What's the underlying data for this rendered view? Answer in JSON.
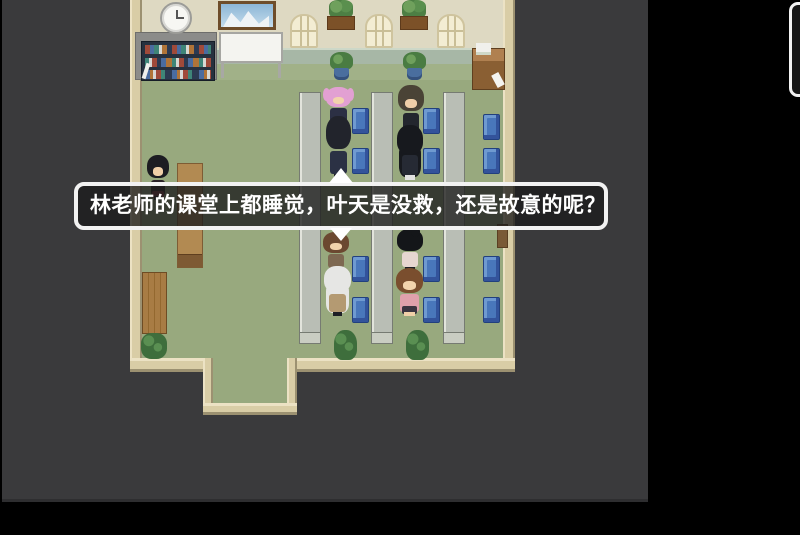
{
  "dialogue": {
    "text": "林老师的课堂上都睡觉，叶天是没救，还是故意的呢？",
    "text_color": "#ffffff",
    "border_color": "#f2f2f2",
    "box_fill": "rgba(28,28,28,0.78)",
    "speaker_tail": "up-triangle",
    "continue_indicator": "down-triangle"
  },
  "palette": {
    "outer_bg": "#000000",
    "viewport_bg": "#3a3a3c",
    "floor_green": "#98a97e",
    "wall_beige": "#ded9c2",
    "wainscot": "#a7b7a6",
    "wall_border_tan": "#d9cda6",
    "desk_gray": "#b9beb5",
    "chair_blue": "#4977bb",
    "wood_brown": "#b28a52"
  },
  "props": [
    {
      "type": "wall-top",
      "x": 142,
      "y": 0,
      "w": 363,
      "h": 48
    },
    {
      "type": "wainscot",
      "x": 142,
      "y": 48,
      "w": 363,
      "h": 17
    },
    {
      "type": "floor-strip",
      "x": 142,
      "y": 64,
      "w": 363,
      "h": 16
    },
    {
      "type": "floor",
      "x": 142,
      "y": 80,
      "w": 363,
      "h": 278
    },
    {
      "type": "wall-left",
      "x": 130,
      "y": 0,
      "w": 12,
      "h": 372
    },
    {
      "type": "wall-right",
      "x": 503,
      "y": 0,
      "w": 12,
      "h": 372
    },
    {
      "type": "wall-bottom",
      "x": 130,
      "y": 358,
      "w": 385,
      "h": 14
    },
    {
      "type": "vest-floor",
      "x": 213,
      "y": 358,
      "w": 74,
      "h": 46
    },
    {
      "type": "vest-wall",
      "x": 203,
      "y": 358,
      "w": 10,
      "h": 57
    },
    {
      "type": "vest-wall",
      "x": 287,
      "y": 358,
      "w": 10,
      "h": 57
    },
    {
      "type": "vest-bottom",
      "x": 203,
      "y": 403,
      "w": 94,
      "h": 12
    },
    {
      "type": "gray-panel",
      "x": 135,
      "y": 32,
      "w": 82,
      "h": 48
    },
    {
      "type": "bookshelf",
      "x": 141,
      "y": 41,
      "w": 74,
      "h": 40
    },
    {
      "type": "whiteboard",
      "x": 219,
      "y": 32,
      "w": 64,
      "h": 46
    },
    {
      "type": "clock",
      "x": 160,
      "y": 2,
      "w": 32,
      "h": 32
    },
    {
      "type": "painting",
      "x": 218,
      "y": 1,
      "w": 58,
      "h": 29
    },
    {
      "type": "window",
      "x": 290,
      "y": 14,
      "w": 28,
      "h": 34
    },
    {
      "type": "window",
      "x": 365,
      "y": 14,
      "w": 28,
      "h": 34
    },
    {
      "type": "window",
      "x": 437,
      "y": 14,
      "w": 28,
      "h": 34
    },
    {
      "type": "wall-planter",
      "x": 327,
      "y": 0,
      "w": 28,
      "h": 30
    },
    {
      "type": "wall-planter",
      "x": 400,
      "y": 0,
      "w": 28,
      "h": 30
    },
    {
      "type": "potted-plant",
      "x": 330,
      "y": 52,
      "w": 23,
      "h": 28
    },
    {
      "type": "potted-plant",
      "x": 403,
      "y": 52,
      "w": 23,
      "h": 28
    },
    {
      "type": "teacher-desk",
      "x": 472,
      "y": 48,
      "w": 33,
      "h": 42
    },
    {
      "type": "wood-table",
      "x": 177,
      "y": 163,
      "w": 26,
      "h": 105
    },
    {
      "type": "plank-table",
      "x": 142,
      "y": 272,
      "w": 25,
      "h": 62
    },
    {
      "type": "bush",
      "x": 141,
      "y": 333,
      "w": 26,
      "h": 26
    },
    {
      "type": "desk",
      "x": 299,
      "y": 92,
      "w": 22,
      "h": 252
    },
    {
      "type": "desk",
      "x": 371,
      "y": 92,
      "w": 22,
      "h": 252
    },
    {
      "type": "desk",
      "x": 443,
      "y": 92,
      "w": 22,
      "h": 252
    },
    {
      "type": "chair",
      "x": 352,
      "y": 108,
      "w": 17,
      "h": 26
    },
    {
      "type": "chair",
      "x": 423,
      "y": 108,
      "w": 17,
      "h": 26
    },
    {
      "type": "chair",
      "x": 483,
      "y": 114,
      "w": 17,
      "h": 26
    },
    {
      "type": "chair",
      "x": 352,
      "y": 148,
      "w": 17,
      "h": 26
    },
    {
      "type": "chair",
      "x": 423,
      "y": 148,
      "w": 17,
      "h": 26
    },
    {
      "type": "chair",
      "x": 483,
      "y": 148,
      "w": 17,
      "h": 26
    },
    {
      "type": "chair",
      "x": 352,
      "y": 256,
      "w": 17,
      "h": 26
    },
    {
      "type": "chair",
      "x": 423,
      "y": 256,
      "w": 17,
      "h": 26
    },
    {
      "type": "chair",
      "x": 483,
      "y": 256,
      "w": 17,
      "h": 26
    },
    {
      "type": "chair",
      "x": 352,
      "y": 297,
      "w": 17,
      "h": 26
    },
    {
      "type": "chair",
      "x": 423,
      "y": 297,
      "w": 17,
      "h": 26
    },
    {
      "type": "chair",
      "x": 483,
      "y": 297,
      "w": 17,
      "h": 26
    },
    {
      "type": "small-plant",
      "x": 334,
      "y": 330,
      "w": 23,
      "h": 30
    },
    {
      "type": "small-plant",
      "x": 406,
      "y": 330,
      "w": 23,
      "h": 30
    },
    {
      "type": "wall-item",
      "x": 497,
      "y": 224,
      "w": 11,
      "h": 24
    }
  ],
  "characters": [
    {
      "id": "teacher-lin",
      "x": 145,
      "y": 155,
      "w": 26,
      "h": 45,
      "hair": "#1d1d22",
      "outfit": "#2a2228",
      "skirt": "#7a3340",
      "face": true,
      "skin": "#f0cfa8"
    },
    {
      "id": "pink-haired-student",
      "x": 324,
      "y": 87,
      "w": 29,
      "h": 38,
      "hair": "#e2a0d2",
      "outfit": "#2c3044",
      "face": true,
      "skin": "#f2d3ac",
      "twintails": true
    },
    {
      "id": "sleeping-student-yetian",
      "x": 324,
      "y": 116,
      "w": 29,
      "h": 64,
      "hair": "#22242c",
      "outfit": "#2b3144",
      "face": false
    },
    {
      "id": "flat-hair-student",
      "x": 396,
      "y": 85,
      "w": 30,
      "h": 50,
      "hair": "#4a4336",
      "outfit": "#23262e",
      "face": true,
      "skin": "#f0cfa8"
    },
    {
      "id": "long-black-hair-student",
      "x": 395,
      "y": 125,
      "w": 30,
      "h": 55,
      "hair": "#17191e",
      "outfit": "#262a34",
      "face": false,
      "longhair": true,
      "legs": "#e2e2e2"
    },
    {
      "id": "brown-haired-student",
      "x": 321,
      "y": 232,
      "w": 30,
      "h": 40,
      "hair": "#6b4830",
      "outfit": "#7d6851",
      "face": true,
      "skin": "#f2d3ac"
    },
    {
      "id": "white-haired-student",
      "x": 322,
      "y": 266,
      "w": 31,
      "h": 50,
      "hair": "#e6e6e4",
      "outfit": "#b49a72",
      "face": false,
      "longhair": true
    },
    {
      "id": "bun-hair-student",
      "x": 395,
      "y": 229,
      "w": 30,
      "h": 42,
      "hair": "#141619",
      "outfit": "#e6d6d0",
      "face": false,
      "bun": true
    },
    {
      "id": "pink-top-student",
      "x": 393,
      "y": 268,
      "w": 33,
      "h": 48,
      "hair": "#7a4e2e",
      "outfit": "#dfa0ab",
      "skirt": "#3a3440",
      "face": true,
      "skin": "#f2d3ac",
      "legs": "#f0d0a8"
    }
  ],
  "overlay": {
    "partial_dialog_top_right": "cut-off rounded frame"
  }
}
